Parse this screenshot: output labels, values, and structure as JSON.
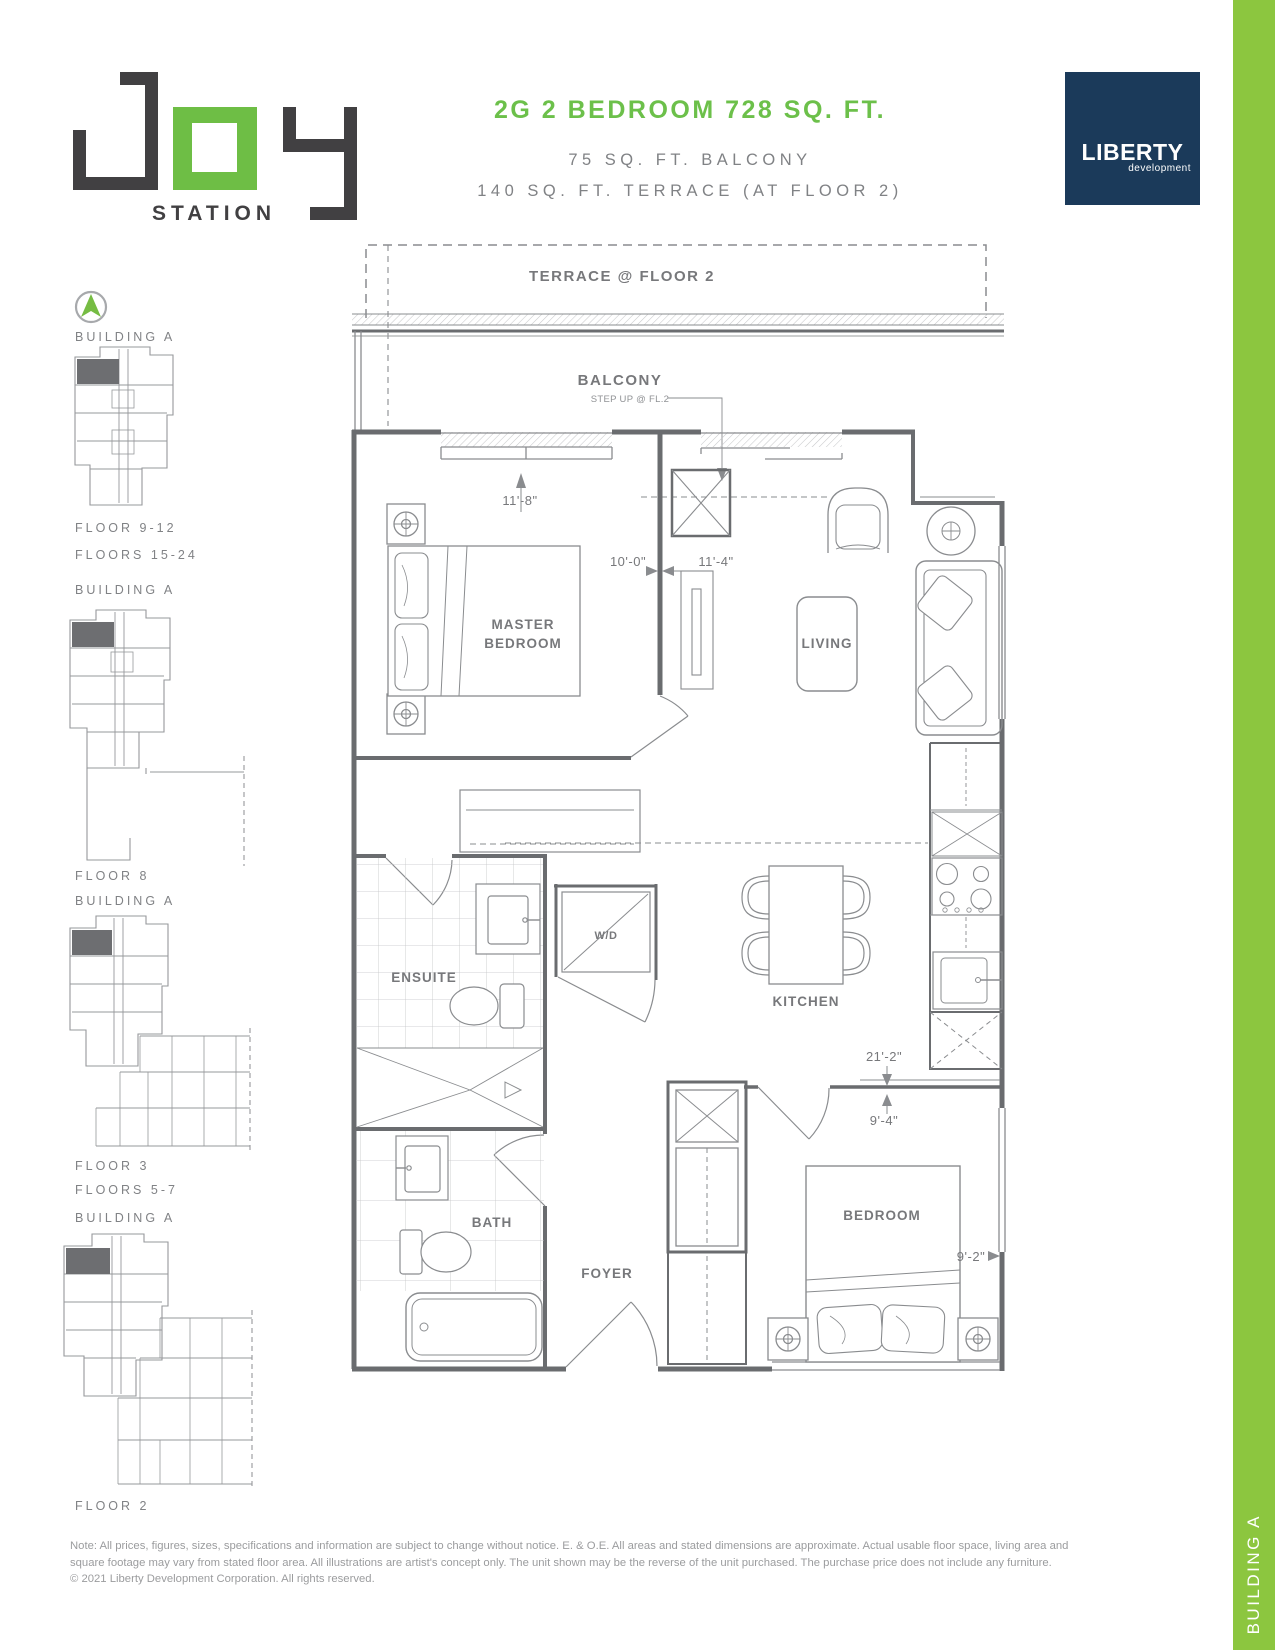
{
  "header": {
    "station_label": "STATION",
    "unit_title": "2G 2 BEDROOM 728 SQ. FT.",
    "balcony_line": "75 SQ. FT. BALCONY",
    "terrace_line": "140 SQ. FT. TERRACE (AT FLOOR 2)",
    "brand_name": "LIBERTY",
    "brand_sub": "development"
  },
  "colors": {
    "accent_green": "#6CC04A",
    "logo_green": "#6EBE45",
    "bar_green": "#8CC63F",
    "brand_navy": "#1B3A5A",
    "plan_gray": "#77787B"
  },
  "sidebar": {
    "sections": [
      {
        "building": "BUILDING A",
        "floors": [
          "FLOOR 9-12",
          "FLOORS 15-24"
        ]
      },
      {
        "building": "BUILDING A",
        "floors": [
          "FLOOR 8"
        ]
      },
      {
        "building": "BUILDING A",
        "floors": [
          "FLOOR 3",
          "FLOORS 5-7"
        ]
      },
      {
        "building": "BUILDING A",
        "floors": [
          "FLOOR 2"
        ]
      }
    ]
  },
  "plan": {
    "terrace": "TERRACE @ FLOOR 2",
    "balcony": "BALCONY",
    "step_note": "STEP UP @ FL.2",
    "rooms": {
      "master_line1": "MASTER",
      "master_line2": "BEDROOM",
      "living": "LIVING",
      "ensuite": "ENSUITE",
      "wd": "W/D",
      "kitchen": "KITCHEN",
      "bath": "BATH",
      "foyer": "FOYER",
      "bedroom": "BEDROOM"
    },
    "dims": {
      "master_width": "11'-8\"",
      "master_depth": "10'-0\"",
      "living_width": "11'-4\"",
      "unit_length": "21'-2\"",
      "bedroom_depth": "9'-4\"",
      "bedroom_width": "9'-2\""
    }
  },
  "side_tab": {
    "label": "BUILDING A"
  },
  "footer": {
    "line1": "Note: All prices, figures, sizes, specifications and information are subject to change without notice. E. & O.E. All areas and stated dimensions are approximate. Actual usable floor space, living area and",
    "line2": "square footage may vary from stated floor area. All illustrations are artist's concept only. The unit shown may be the reverse of the unit purchased. The purchase price does not include any furniture.",
    "line3": "© 2021 Liberty Development Corporation. All rights reserved."
  }
}
